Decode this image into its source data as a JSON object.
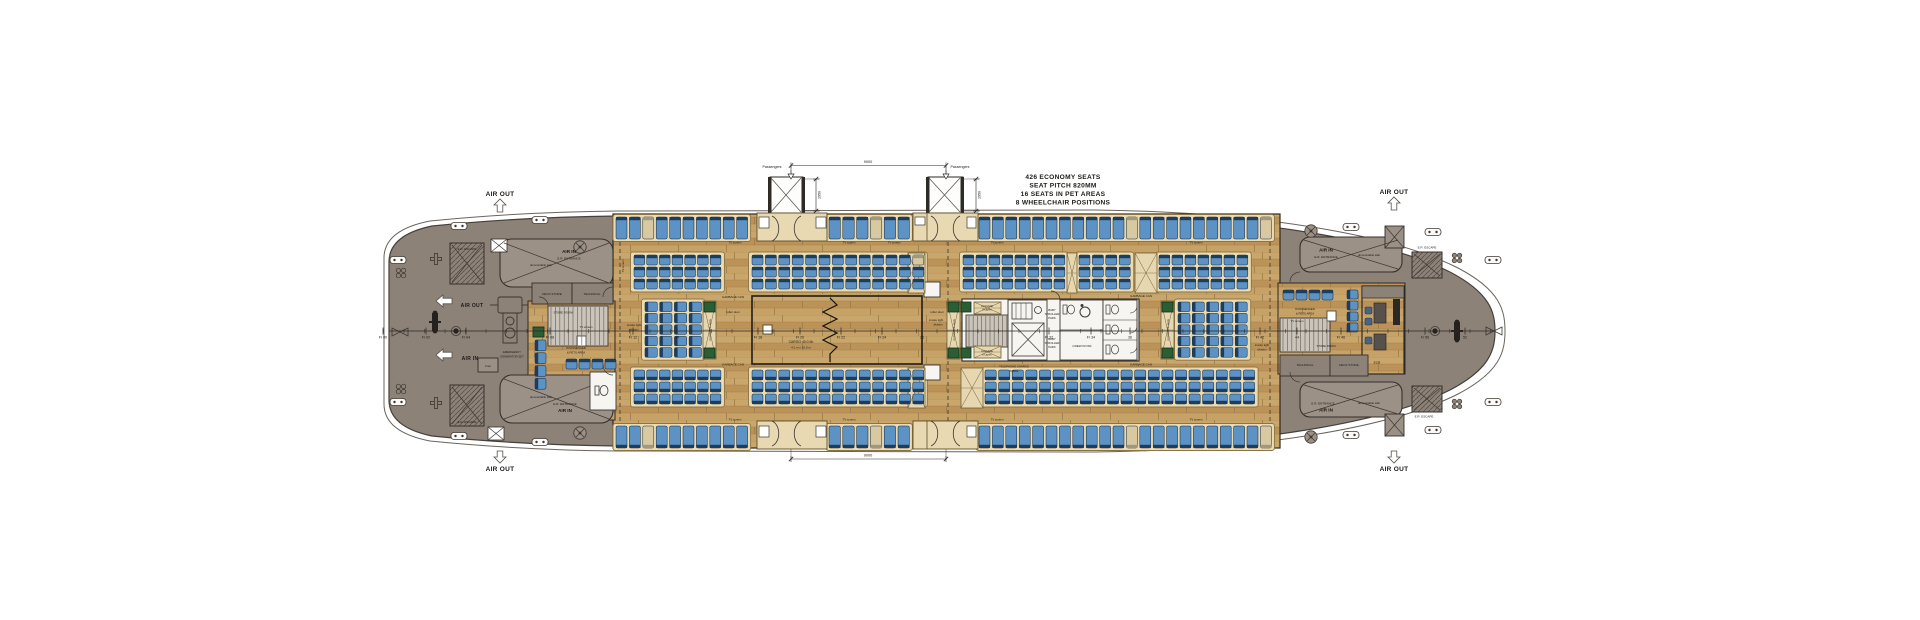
{
  "title": "Ferry passenger deck general arrangement plan",
  "annotation": {
    "lines": [
      "426 ECONOMY SEATS",
      "SEAT PITCH 820MM",
      "16 SEATS IN PET AREAS",
      "8 WHEELCHAIR POSITIONS"
    ],
    "x": 1063,
    "y": 179,
    "line_h": 8.5,
    "size": 6.6
  },
  "colors": {
    "hull_gray": "#8d8278",
    "hull_line": "#46403a",
    "wood": "#c29c62",
    "seat_blue": "#5d92c5",
    "seat_back": "#1d3d5e",
    "seat_stroke": "#10253c",
    "beige": "#d8c9a3",
    "beige_back": "#a4987a",
    "platform": "#ecdbb1",
    "platform_stroke": "#8a7444",
    "green": "#2c5e34",
    "white_room": "#f6f5f1",
    "ink": "#1c1a17"
  },
  "airflow": [
    {
      "t": "AIR OUT",
      "x": 500,
      "y": 196,
      "s": 6.5,
      "b": 1,
      "dir": "up",
      "cx": 500,
      "y1": 199,
      "y2": 212
    },
    {
      "t": "AIR OUT",
      "x": 1394,
      "y": 194,
      "s": 6.5,
      "b": 1,
      "dir": "up",
      "cx": 1394,
      "y1": 197,
      "y2": 210
    },
    {
      "t": "AIR OUT",
      "x": 500,
      "y": 471,
      "s": 6.5,
      "b": 1,
      "dir": "down",
      "cx": 500,
      "y1": 451,
      "y2": 463
    },
    {
      "t": "AIR OUT",
      "x": 1394,
      "y": 471,
      "s": 6.5,
      "b": 1,
      "dir": "down",
      "cx": 1394,
      "y1": 451,
      "y2": 463
    },
    {
      "t": "AIR OUT",
      "x": 472,
      "y": 307,
      "s": 5,
      "b": 1,
      "dir": "left",
      "cx": 436,
      "cy": 301
    },
    {
      "t": "AIR IN",
      "x": 470,
      "y": 360,
      "s": 5,
      "b": 1,
      "dir": "left",
      "cx": 436,
      "cy": 355
    }
  ],
  "passengers": [
    {
      "t": "Passengers",
      "x": 772,
      "y": 168,
      "ax": 791
    },
    {
      "t": "Passengers",
      "x": 960,
      "y": 168,
      "ax": 946
    }
  ],
  "dims": {
    "h": [
      {
        "x1": 791,
        "x2": 946,
        "y": 165.5,
        "t": "9000",
        "lx": 868,
        "ly": 163,
        "wy": 177
      },
      {
        "x1": 791,
        "x2": 946,
        "y": 459,
        "t": "9000",
        "lx": 868,
        "ly": 456.5,
        "wy": 449
      }
    ],
    "v": [
      {
        "x": 816,
        "y1": 179,
        "y2": 211,
        "t": "1950"
      },
      {
        "x": 976,
        "y1": 179,
        "y2": 211,
        "t": "1950"
      }
    ]
  },
  "frames": [
    {
      "t": "Fr 00",
      "x": 383
    },
    {
      "t": "Fr 02",
      "x": 426
    },
    {
      "t": "Fr 04",
      "x": 466
    },
    {
      "t": "Fr 08",
      "x": 550
    },
    {
      "t": "Fr 12",
      "x": 633
    },
    {
      "t": "14",
      "x": 677
    },
    {
      "t": "Fr 18",
      "x": 758
    },
    {
      "t": "Fr 20",
      "x": 800
    },
    {
      "t": "Fr 22",
      "x": 841
    },
    {
      "t": "Fr 24",
      "x": 882
    },
    {
      "t": "26",
      "x": 922
    },
    {
      "t": "Fr 32",
      "x": 1049
    },
    {
      "t": "Fr 34",
      "x": 1091
    },
    {
      "t": "36",
      "x": 1130
    },
    {
      "t": "Fr 42",
      "x": 1260
    },
    {
      "t": "44",
      "x": 1297
    },
    {
      "t": "Fr 46",
      "x": 1341
    },
    {
      "t": "Fr 50",
      "x": 1425
    },
    {
      "t": "52",
      "x": 1465
    }
  ],
  "labels": [
    {
      "t": "E.R. ESCAPE",
      "x": 467,
      "y": 250,
      "s": 3
    },
    {
      "t": "E.R. ESCAPE",
      "x": 467,
      "y": 423,
      "s": 3
    },
    {
      "t": "AIR IN",
      "x": 569,
      "y": 253,
      "s": 4.6,
      "b": 1
    },
    {
      "t": "E.R. ENTRANCE",
      "x": 569,
      "y": 259.5,
      "s": 3
    },
    {
      "t": "demountable stair",
      "x": 541,
      "y": 266,
      "s": 2.8
    },
    {
      "t": "demountable stair",
      "x": 541,
      "y": 398,
      "s": 2.8
    },
    {
      "t": "E.R. ENTRANCE",
      "x": 565,
      "y": 405,
      "s": 3
    },
    {
      "t": "AIR IN",
      "x": 565,
      "y": 412,
      "s": 4.6,
      "b": 1
    },
    {
      "t": "DECK STORE",
      "x": 552,
      "y": 295,
      "s": 3
    },
    {
      "t": "TECHNICAL",
      "x": 592,
      "y": 295,
      "s": 3
    },
    {
      "t": "STORE ROOM",
      "x": 563,
      "y": 313.5,
      "s": 2.8
    },
    {
      "t": "EMERGENCY",
      "x": 512,
      "y": 353,
      "s": 2.8
    },
    {
      "t": "GENERATOR SET",
      "x": 512,
      "y": 357.5,
      "s": 2.8
    },
    {
      "t": "Fuel",
      "x": 488,
      "y": 367,
      "s": 2.8
    },
    {
      "t": "8 PASSENGER",
      "x": 576,
      "y": 349,
      "s": 2.8
    },
    {
      "t": "& PETS AREA",
      "x": 576,
      "y": 353.5,
      "s": 2.8
    },
    {
      "t": "TV screen",
      "x": 586,
      "y": 328,
      "s": 2.8
    },
    {
      "t": "smoke tight",
      "x": 634,
      "y": 326,
      "s": 2.8
    },
    {
      "t": "division",
      "x": 634,
      "y": 330.5,
      "s": 2.8
    },
    {
      "t": "GARBAGE CAN",
      "x": 733,
      "y": 298,
      "s": 3
    },
    {
      "t": "GARBAGE CAN",
      "x": 733,
      "y": 365.5,
      "s": 3
    },
    {
      "t": "roller door",
      "x": 733,
      "y": 313,
      "s": 3
    },
    {
      "t": "roller door",
      "x": 937,
      "y": 313,
      "s": 3
    },
    {
      "t": "smoke tight",
      "x": 936,
      "y": 321,
      "s": 2.8
    },
    {
      "t": "division",
      "x": 938,
      "y": 325.5,
      "s": 2.8
    },
    {
      "t": "CARGO 40.0 M²",
      "x": 801,
      "y": 343,
      "s": 3.4
    },
    {
      "t": "4.1 m x 10.0 m",
      "x": 801,
      "y": 348.5,
      "s": 3
    },
    {
      "t": "LUGGAGE",
      "x": 987,
      "y": 307,
      "s": 2.4
    },
    {
      "t": "8 Layers",
      "x": 987,
      "y": 310.5,
      "s": 2.4
    },
    {
      "t": "LUGGAGE",
      "x": 987,
      "y": 352,
      "s": 2.4
    },
    {
      "t": "8 Layers",
      "x": 987,
      "y": 355.5,
      "s": 2.4
    },
    {
      "t": "BABY",
      "x": 1052,
      "y": 311,
      "s": 2.8
    },
    {
      "t": "STROLLER",
      "x": 1052,
      "y": 315,
      "s": 2.8
    },
    {
      "t": "PARK",
      "x": 1052,
      "y": 319,
      "s": 2.8
    },
    {
      "t": "BABY",
      "x": 1052,
      "y": 340,
      "s": 2.8
    },
    {
      "t": "STROLLER",
      "x": 1052,
      "y": 344,
      "s": 2.8
    },
    {
      "t": "PARK",
      "x": 1052,
      "y": 348,
      "s": 2.8
    },
    {
      "t": "CREW KIOSK",
      "x": 1082,
      "y": 347,
      "s": 3
    },
    {
      "t": "TELEPHONE CHARGE",
      "x": 1014,
      "y": 367.5,
      "s": 2.8
    },
    {
      "t": "TABLE",
      "x": 1014,
      "y": 372,
      "s": 2.8
    },
    {
      "t": "GARBAGE CAN",
      "x": 1141,
      "y": 297,
      "s": 3
    },
    {
      "t": "GARBAGE CAN",
      "x": 1141,
      "y": 365.5,
      "s": 3
    },
    {
      "t": "8 PASSENGER",
      "x": 1305,
      "y": 310,
      "s": 2.8
    },
    {
      "t": "& PETS AREA",
      "x": 1305,
      "y": 314.5,
      "s": 2.8
    },
    {
      "t": "TV screen",
      "x": 1297,
      "y": 322,
      "s": 2.8
    },
    {
      "t": "smoke tight",
      "x": 1262,
      "y": 346,
      "s": 2.8
    },
    {
      "t": "division",
      "x": 1262,
      "y": 350.5,
      "s": 2.8
    },
    {
      "t": "STORE ROOM",
      "x": 1326,
      "y": 347,
      "s": 2.8
    },
    {
      "t": "TECHNICAL",
      "x": 1305,
      "y": 366,
      "s": 3
    },
    {
      "t": "DECK STORE",
      "x": 1349,
      "y": 366,
      "s": 3
    },
    {
      "t": "ECR",
      "x": 1377,
      "y": 364,
      "s": 3.2
    },
    {
      "t": "AIR IN",
      "x": 1326,
      "y": 251.5,
      "s": 4.6,
      "b": 1
    },
    {
      "t": "E.R. ENTRANCE",
      "x": 1326,
      "y": 258,
      "s": 3
    },
    {
      "t": "demountable stair",
      "x": 1369,
      "y": 256,
      "s": 2.8
    },
    {
      "t": "E.R. ESCAPE",
      "x": 1427,
      "y": 248.5,
      "s": 3
    },
    {
      "t": "E.R. ENTRANCE",
      "x": 1323,
      "y": 404.5,
      "s": 3
    },
    {
      "t": "AIR IN",
      "x": 1326,
      "y": 411.5,
      "s": 4.6,
      "b": 1
    },
    {
      "t": "demountable stair",
      "x": 1369,
      "y": 404,
      "s": 2.8
    },
    {
      "t": "E.R. ESCAPE",
      "x": 1424,
      "y": 417.5,
      "s": 3
    },
    {
      "t": "TV screen",
      "x": 735,
      "y": 243.5,
      "s": 2.8
    },
    {
      "t": "TV screen",
      "x": 849,
      "y": 243.5,
      "s": 2.8
    },
    {
      "t": "TV screen",
      "x": 894,
      "y": 243.5,
      "s": 2.8
    },
    {
      "t": "TV screen",
      "x": 997,
      "y": 243.5,
      "s": 2.8
    },
    {
      "t": "TV screen",
      "x": 1196,
      "y": 243.5,
      "s": 2.8
    },
    {
      "t": "TV screen",
      "x": 735,
      "y": 420.5,
      "s": 2.8
    },
    {
      "t": "TV screen",
      "x": 849,
      "y": 420.5,
      "s": 2.8
    },
    {
      "t": "TV screen",
      "x": 997,
      "y": 420.5,
      "s": 2.8
    },
    {
      "t": "TV screen",
      "x": 1196,
      "y": 420.5,
      "s": 2.8
    },
    {
      "t": "TV screen",
      "x": 624,
      "y": 266,
      "s": 2.8,
      "r": -90
    },
    {
      "t": "LUGGAGE 8 Layers",
      "x": 711,
      "y": 330,
      "s": 2.4,
      "r": -90
    },
    {
      "t": "LUGGAGE 8 Layers",
      "x": 955,
      "y": 330,
      "s": 2.4,
      "r": -90
    },
    {
      "t": "LUGGAGE 8 Layers",
      "x": 1169,
      "y": 330,
      "s": 2.4,
      "r": -90
    }
  ],
  "seat_rows": [
    {
      "x": 616,
      "y": 217,
      "n": 10,
      "p": 13.4,
      "w": 11,
      "h": 22,
      "dir": "down",
      "bg": [
        2
      ]
    },
    {
      "x": 829,
      "y": 217,
      "n": 6,
      "p": 13.8,
      "w": 11.4,
      "h": 22,
      "dir": "down",
      "bg": [
        3
      ]
    },
    {
      "x": 979,
      "y": 217,
      "n": 22,
      "p": 13.4,
      "w": 11,
      "h": 22,
      "dir": "down",
      "bg": [
        11,
        21
      ]
    },
    {
      "x": 616,
      "y": 426,
      "n": 10,
      "p": 13.4,
      "w": 11,
      "h": 22,
      "dir": "up",
      "bg": [
        2
      ]
    },
    {
      "x": 829,
      "y": 426,
      "n": 6,
      "p": 13.8,
      "w": 11.4,
      "h": 22,
      "dir": "up",
      "bg": [
        3
      ]
    },
    {
      "x": 979,
      "y": 426,
      "n": 22,
      "p": 13.4,
      "w": 11,
      "h": 22,
      "dir": "up",
      "bg": [
        11,
        21
      ]
    }
  ],
  "seat_blocks": [
    {
      "x": 634,
      "y": 255,
      "c": 7,
      "r": 3,
      "px": 12.7,
      "py": 12,
      "w": 10.7,
      "h": 10,
      "dir": "down",
      "pf": 1
    },
    {
      "x": 752,
      "y": 255,
      "c": 13,
      "r": 3,
      "px": 13.4,
      "py": 12,
      "w": 11,
      "h": 10,
      "dir": "down",
      "pf": 1,
      "bg": [
        [
          0,
          12
        ]
      ]
    },
    {
      "x": 963,
      "y": 255,
      "c": 8,
      "r": 3,
      "px": 13,
      "py": 12,
      "w": 10.8,
      "h": 10,
      "dir": "down",
      "pf": 1
    },
    {
      "x": 1079,
      "y": 255,
      "c": 4,
      "r": 3,
      "px": 13.4,
      "py": 12,
      "w": 11,
      "h": 10,
      "dir": "down",
      "pf": 1
    },
    {
      "x": 1159,
      "y": 255,
      "c": 7,
      "r": 3,
      "px": 13,
      "py": 12,
      "w": 10.8,
      "h": 10,
      "dir": "down",
      "pf": 1
    },
    {
      "x": 634,
      "y": 370,
      "c": 7,
      "r": 3,
      "px": 12.7,
      "py": 12,
      "w": 10.7,
      "h": 10,
      "dir": "up",
      "pf": 1
    },
    {
      "x": 752,
      "y": 370,
      "c": 13,
      "r": 3,
      "px": 13.4,
      "py": 12,
      "w": 11,
      "h": 10,
      "dir": "up",
      "pf": 1
    },
    {
      "x": 985,
      "y": 370,
      "c": 20,
      "r": 3,
      "px": 13.6,
      "py": 12,
      "w": 11.2,
      "h": 10,
      "dir": "up",
      "pf": 1
    },
    {
      "x": 645,
      "y": 302,
      "c": 4,
      "r": 5,
      "px": 14.7,
      "py": 11.4,
      "w": 12.3,
      "h": 9.6,
      "dir": "right",
      "pf": 1
    },
    {
      "x": 1178,
      "y": 302,
      "c": 5,
      "r": 5,
      "px": 14.3,
      "py": 11.4,
      "w": 12,
      "h": 9.6,
      "dir": "right",
      "pf": 1
    },
    {
      "x": 535,
      "y": 340,
      "c": 1,
      "r": 4,
      "px": 13,
      "py": 12.8,
      "w": 11,
      "h": 10.8,
      "dir": "right"
    },
    {
      "x": 566,
      "y": 359,
      "c": 4,
      "r": 1,
      "px": 13,
      "py": 12,
      "w": 11,
      "h": 10,
      "dir": "down"
    },
    {
      "x": 1283,
      "y": 290,
      "c": 4,
      "r": 1,
      "px": 13,
      "py": 12,
      "w": 11,
      "h": 10,
      "dir": "down"
    },
    {
      "x": 1347,
      "y": 290,
      "c": 1,
      "r": 4,
      "px": 13,
      "py": 11,
      "w": 11,
      "h": 9,
      "dir": "right"
    }
  ],
  "luggage": [
    {
      "x": 908,
      "y": 253,
      "w": 17,
      "h": 40
    },
    {
      "x": 1067,
      "y": 253,
      "w": 10,
      "h": 40
    },
    {
      "x": 1135,
      "y": 253,
      "w": 22,
      "h": 40
    },
    {
      "x": 908,
      "y": 368,
      "w": 17,
      "h": 40
    },
    {
      "x": 961,
      "y": 368,
      "w": 22,
      "h": 40
    },
    {
      "x": 703,
      "y": 301,
      "w": 13,
      "h": 58
    },
    {
      "x": 947,
      "y": 301,
      "w": 13,
      "h": 58
    },
    {
      "x": 1161,
      "y": 301,
      "w": 13,
      "h": 58
    },
    {
      "x": 974,
      "y": 302,
      "w": 27,
      "h": 12
    },
    {
      "x": 974,
      "y": 346,
      "w": 27,
      "h": 12
    }
  ],
  "greens": [
    {
      "x": 704,
      "y": 302,
      "w": 11,
      "h": 10
    },
    {
      "x": 704,
      "y": 348,
      "w": 11,
      "h": 10
    },
    {
      "x": 948,
      "y": 302,
      "w": 11,
      "h": 10
    },
    {
      "x": 948,
      "y": 348,
      "w": 11,
      "h": 10
    },
    {
      "x": 1162,
      "y": 302,
      "w": 11,
      "h": 10
    },
    {
      "x": 1162,
      "y": 348,
      "w": 11,
      "h": 10
    },
    {
      "x": 961,
      "y": 302,
      "w": 10,
      "h": 10
    },
    {
      "x": 961,
      "y": 348,
      "w": 10,
      "h": 10
    },
    {
      "x": 533,
      "y": 327,
      "w": 11,
      "h": 10
    }
  ],
  "equipment": {
    "cleats": [
      [
        398,
        260
      ],
      [
        398,
        402
      ],
      [
        459,
        226
      ],
      [
        459,
        436
      ],
      [
        540,
        220
      ],
      [
        540,
        442
      ],
      [
        1351,
        227
      ],
      [
        1351,
        435
      ],
      [
        1433,
        232
      ],
      [
        1433,
        430
      ],
      [
        1493,
        260
      ],
      [
        1493,
        402
      ]
    ],
    "clovers": [
      [
        401,
        273
      ],
      [
        401,
        389
      ],
      [
        1457,
        258
      ],
      [
        1457,
        404
      ]
    ],
    "crosses": [
      [
        436,
        259
      ],
      [
        436,
        403
      ]
    ],
    "fans": [
      [
        580,
        247
      ],
      [
        580,
        433
      ],
      [
        1311,
        231
      ],
      [
        1311,
        437
      ]
    ],
    "winches": [
      [
        435,
        322
      ],
      [
        1457,
        331
      ]
    ],
    "bowties": [
      [
        400,
        332
      ],
      [
        1494,
        331
      ]
    ],
    "dots": [
      [
        456,
        331
      ],
      [
        1435,
        331
      ]
    ]
  }
}
